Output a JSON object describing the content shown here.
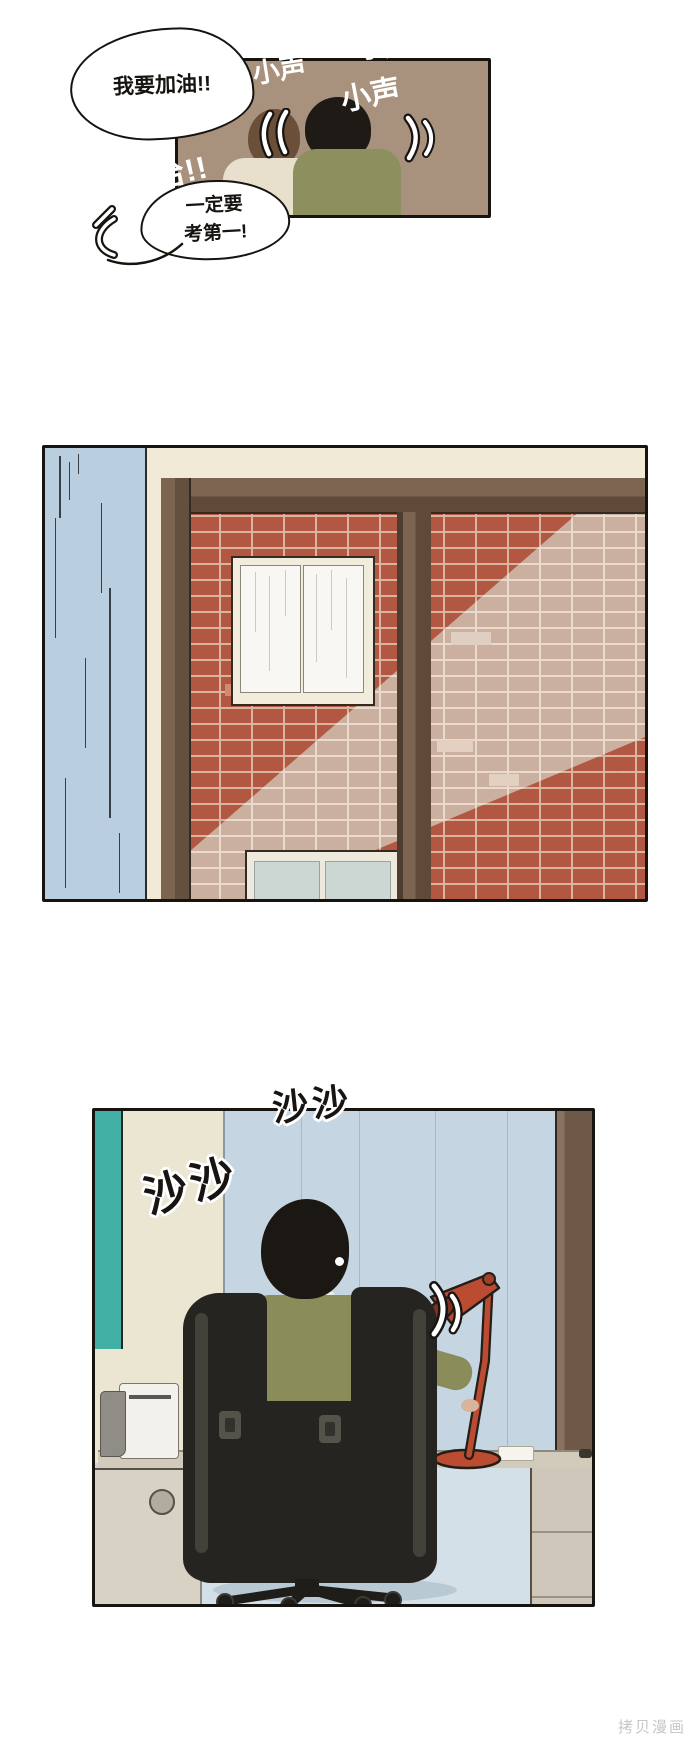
{
  "page": {
    "background": "#ffffff",
    "watermark_text": "拷贝漫画"
  },
  "panel_classroom": {
    "bubble_cheer": "我要加油!!",
    "laugh_sfx": "呜哈哈哈!!",
    "tally_mark": "卅",
    "bubble_resolve_line1": "一定要",
    "bubble_resolve_line2": "考第一!",
    "whisper_sfx": "小声",
    "wall_color": "#a8917d",
    "left_person": {
      "hair_color": "#6b4f38",
      "shirt_color": "#e8e0cd"
    },
    "right_person": {
      "hair_color": "#1e1a16",
      "shirt_color": "#8d8f5f"
    }
  },
  "panel_window": {
    "curtain_color": "#b9cedf",
    "wall_color": "#f0ead6",
    "frame_color": "#7d6450",
    "brick_color": "#b25742",
    "brick_sunlit_color": "#cbaf9f",
    "window_pane_color": "#f9f7f3",
    "lower_window_pane_color": "#ccd7d4"
  },
  "panel_desk": {
    "rustle_sfx": "沙沙",
    "wall_color": "#c5d6e2",
    "accent_teal": "#43b0a5",
    "side_wall_color": "#ebe6d1",
    "shirt_color": "#8a8c5a",
    "chair_color": "#262420",
    "lamp_color": "#bb4c31",
    "desk_color": "#d2cabb"
  }
}
